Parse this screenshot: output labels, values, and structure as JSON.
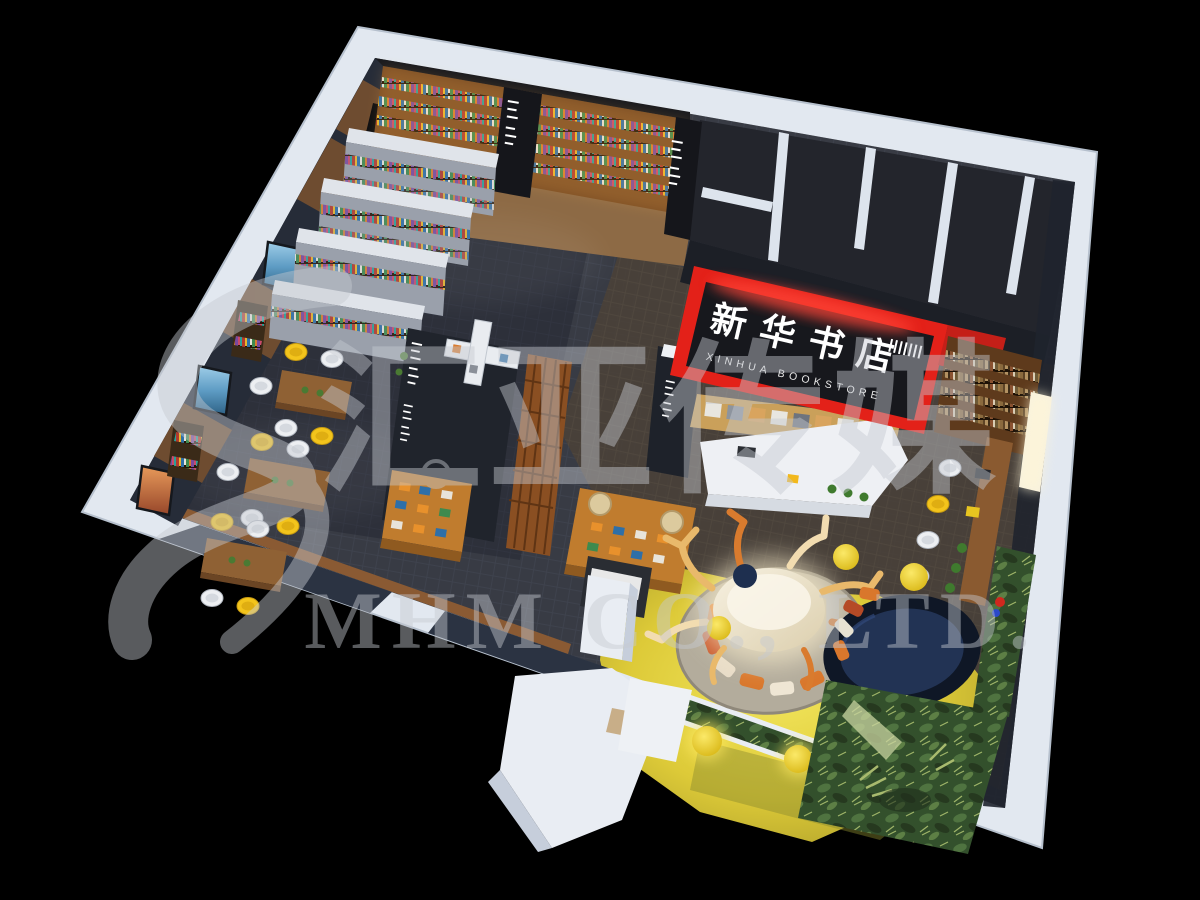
{
  "signage": {
    "store_name_zh": "新华书店",
    "store_name_en": "XINHUA BOOKSTORE"
  },
  "watermark": {
    "company_zh": "汇亚传媒",
    "company_en": "MHM CO., LTD."
  },
  "colors": {
    "background": "#000000",
    "wall_white": "#e2e8f0",
    "accent_red": "#e32119",
    "floor_dark_carpet": "#3a3d45",
    "floor_yellow": "#e8d84a",
    "wood_shelf": "#8a5a28",
    "chair_yellow": "#f3c41c",
    "jungle_green": "#33502c",
    "navy_pit": "#223354",
    "watermark_gray": "#c6cad1"
  }
}
